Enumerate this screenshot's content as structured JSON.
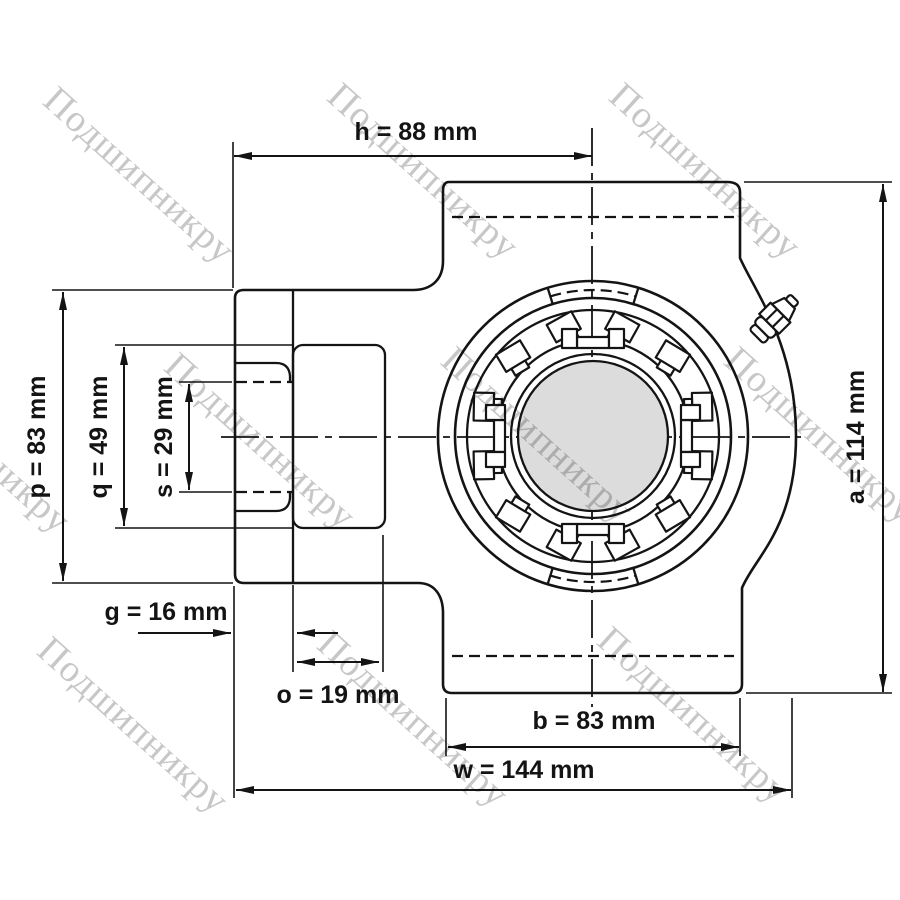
{
  "drawing_title": "",
  "watermark": {
    "text": "Подшипникру",
    "color": "#c7c7c7"
  },
  "dimensions": {
    "h": {
      "name": "h",
      "value": 88,
      "unit": "mm",
      "label": "h = 88 mm"
    },
    "a": {
      "name": "a",
      "value": 114,
      "unit": "mm",
      "label": "a = 114 mm"
    },
    "p": {
      "name": "p",
      "value": 83,
      "unit": "mm",
      "label": "p = 83 mm"
    },
    "q": {
      "name": "q",
      "value": 49,
      "unit": "mm",
      "label": "q = 49 mm"
    },
    "s": {
      "name": "s",
      "value": 29,
      "unit": "mm",
      "label": "s = 29 mm"
    },
    "g": {
      "name": "g",
      "value": 16,
      "unit": "mm",
      "label": "g = 16 mm"
    },
    "o": {
      "name": "o",
      "value": 19,
      "unit": "mm",
      "label": "o = 19 mm"
    },
    "b": {
      "name": "b",
      "value": 83,
      "unit": "mm",
      "label": "b = 83 mm"
    },
    "w": {
      "name": "w",
      "value": 144,
      "unit": "mm",
      "label": "w = 144 mm"
    }
  },
  "colors": {
    "line": "#141414",
    "shaft_fill": "#dcdcdc",
    "watermark": "#c7c7c7",
    "background": "#ffffff"
  }
}
